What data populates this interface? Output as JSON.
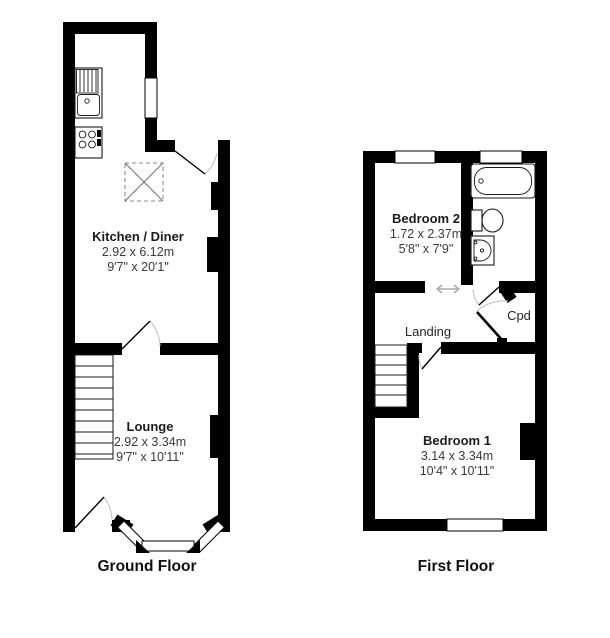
{
  "ground_floor": {
    "label": "Ground Floor",
    "rooms": {
      "kitchen": {
        "name": "Kitchen / Diner",
        "metric": "2.92 x 6.12m",
        "imperial": "9'7\" x 20'1\""
      },
      "lounge": {
        "name": "Lounge",
        "metric": "2.92 x 3.34m",
        "imperial": "9'7\" x 10'11\""
      }
    }
  },
  "first_floor": {
    "label": "First Floor",
    "rooms": {
      "bedroom2": {
        "name": "Bedroom 2",
        "metric": "1.72 x 2.37m",
        "imperial": "5'8\" x 7'9\""
      },
      "bedroom1": {
        "name": "Bedroom 1",
        "metric": "3.14 x 3.34m",
        "imperial": "10'4\" x 10'11\""
      },
      "landing": {
        "name": "Landing"
      },
      "cupboard": {
        "name": "Cpd"
      }
    }
  },
  "fixtures": [
    "bath-icon",
    "toilet-icon",
    "basin-icon",
    "kitchen-sink-icon",
    "hob-icon",
    "stairs-icon",
    "skylight-icon",
    "sliding-door-arrow-icon",
    "bay-window",
    "door-swing-arc"
  ],
  "colors": {
    "wall": "#000000",
    "room_name": "#1c1c1c",
    "dimension_text": "#3a3a3a",
    "door_arc": "#c4c4c4",
    "fixture_line": "#1a1a1a",
    "skylight_dash": "#8c8c8c",
    "slide_arrow": "#ababab",
    "background": "#ffffff"
  }
}
